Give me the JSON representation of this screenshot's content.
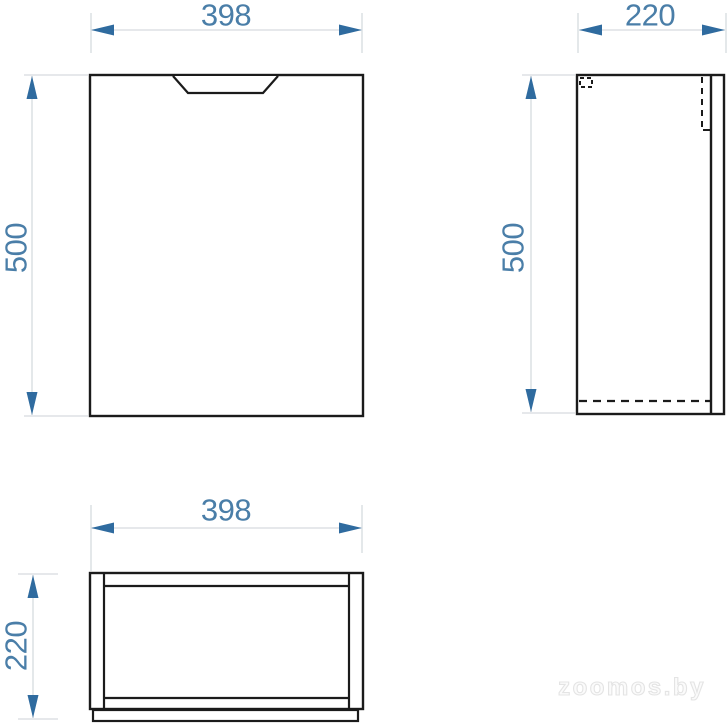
{
  "drawing": {
    "type": "furniture-dimension-drawing",
    "views": {
      "front": {
        "width_label": "398",
        "height_label": "500"
      },
      "side": {
        "width_label": "220",
        "height_label": "500"
      },
      "top": {
        "width_label": "398",
        "depth_label": "220"
      }
    },
    "colors": {
      "outline": "#1b1b1b",
      "dimension_text": "#4a7ea8",
      "arrowhead": "#2f6b9f",
      "extension_line": "#d6dbdf",
      "watermark": "#e4e4e4",
      "background": "#ffffff"
    }
  },
  "watermark": {
    "text": "zoomos.by"
  }
}
